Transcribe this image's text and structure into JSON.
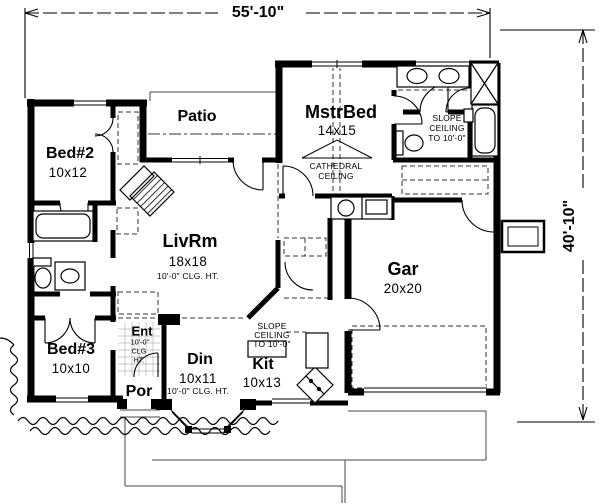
{
  "drawing_title": "single-story house floor plan",
  "dimensions": {
    "overall_width": "55'-10\"",
    "overall_depth": "40'-10\""
  },
  "rooms": {
    "patio": {
      "label": "Patio"
    },
    "bed2": {
      "label": "Bed#2",
      "size": "10x12"
    },
    "mstrbed": {
      "label": "MstrBed",
      "size": "14x15"
    },
    "livrm": {
      "label": "LivRm",
      "size": "18x18",
      "ceiling": "10'-0\" CLG. HT."
    },
    "gar": {
      "label": "Gar",
      "size": "20x20"
    },
    "bed3": {
      "label": "Bed#3",
      "size": "10x10"
    },
    "din": {
      "label": "Din",
      "size": "10x11",
      "ceiling": "10'-0\" CLG. HT."
    },
    "kit": {
      "label": "Kit",
      "size": "10x13"
    },
    "ent": {
      "label": "Ent",
      "ceiling_l1": "10'-0\"",
      "ceiling_l2": "CLG",
      "ceiling_l3": "HT."
    },
    "por": {
      "label": "Por"
    }
  },
  "annotations": {
    "cathedral_l1": "CATHEDRAL",
    "cathedral_l2": "CEILING",
    "slope_bath_l1": "SLOPE",
    "slope_bath_l2": "CEILING",
    "slope_bath_l3": "TO 10'-0\"",
    "slope_kit_l1": "SLOPE",
    "slope_kit_l2": "CEILING",
    "slope_kit_l3": "TO 10'-0\""
  },
  "colors": {
    "ink": "#000000",
    "paper": "#ffffff"
  }
}
